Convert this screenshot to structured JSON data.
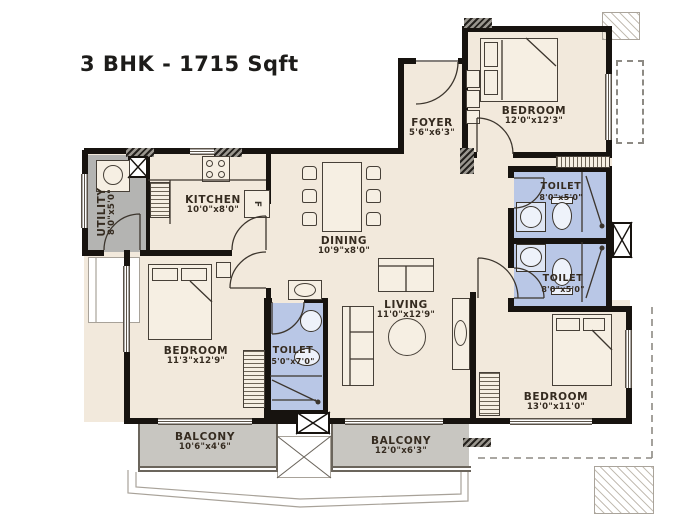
{
  "title": "3 BHK - 1715 Sqft",
  "rooms": [
    {
      "id": "foyer",
      "name": "FOYER",
      "dims": "5'6\"x6'3\""
    },
    {
      "id": "kitchen",
      "name": "KITCHEN",
      "dims": "10'0\"x8'0\""
    },
    {
      "id": "utility",
      "name": "UTILITY",
      "dims": "8'0\"x5'0\""
    },
    {
      "id": "dining",
      "name": "DINING",
      "dims": "10'9\"x8'0\""
    },
    {
      "id": "living",
      "name": "LIVING",
      "dims": "11'0\"x12'9\""
    },
    {
      "id": "bedroom-top-right",
      "name": "BEDROOM",
      "dims": "12'0\"x12'3\""
    },
    {
      "id": "toilet-top-right",
      "name": "TOILET",
      "dims": "8'0\"x5'0\""
    },
    {
      "id": "toilet-mid-right",
      "name": "TOILET",
      "dims": "8'0\"x5'0\""
    },
    {
      "id": "bedroom-bottom-right",
      "name": "BEDROOM",
      "dims": "13'0\"x11'0\""
    },
    {
      "id": "toilet-inner",
      "name": "TOILET",
      "dims": "5'0\"x7'0\""
    },
    {
      "id": "bedroom-bottom-left",
      "name": "BEDROOM",
      "dims": "11'3\"x12'9\""
    },
    {
      "id": "balcony-left",
      "name": "BALCONY",
      "dims": "10'6\"x4'6\""
    },
    {
      "id": "balcony-right",
      "name": "BALCONY",
      "dims": "12'0\"x6'3\""
    }
  ],
  "fixtures": {
    "fridge_label": "F"
  },
  "colors": {
    "wall": "#17130f",
    "floor": "#f2e9dc",
    "toilet_floor": "#b9c7e6",
    "utility_floor": "#b4b4b2",
    "balcony_floor": "#c8c6c1"
  }
}
